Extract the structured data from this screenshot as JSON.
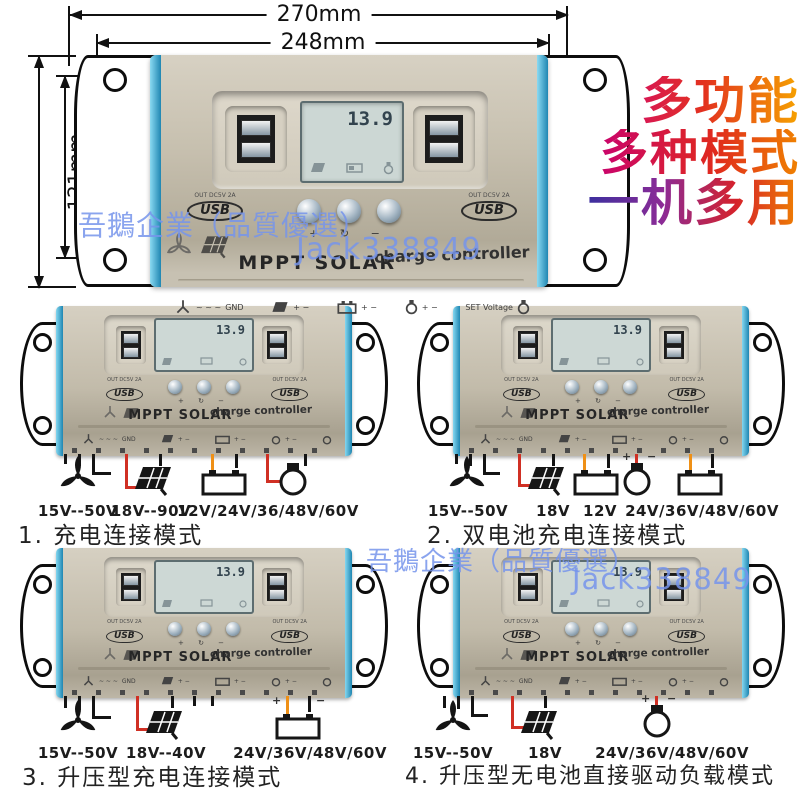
{
  "dimensions": {
    "top_outer": "270mm",
    "top_inner": "248mm",
    "side_outer": "121mm",
    "side_inner": "95mm"
  },
  "promo": {
    "line1": "多功能",
    "line2": "多种模式",
    "line3": "一机多用",
    "colors": {
      "magenta": "#cf0080",
      "red": "#e02a1d",
      "orange": "#f6a300",
      "purple": "#3c2f9f"
    }
  },
  "watermark": {
    "company": "吾鵝企業（品質優選）",
    "user": "Jack338849",
    "color": "#7694eb"
  },
  "controller": {
    "lcd_value": "13.9",
    "brand": "MPPT SOLAR",
    "product": "charge controller",
    "usb_output": "OUT DC5V 2A",
    "usb_logo": "USB",
    "gnd": "GND",
    "ac_marks": "~ ~ ~",
    "polarity": "+ −",
    "plus": "+",
    "minus": "−",
    "set_voltage": "SET Voltage",
    "button_glyphs": "+ ↻ −",
    "body_color": "#c6bfae",
    "accent_blue": "#2f96c0",
    "wire_colors": {
      "black": "#141414",
      "red": "#d03024",
      "orange": "#ef9016"
    }
  },
  "diagrams": [
    {
      "caption": "1. 充电连接模式",
      "labels": [
        {
          "text": "15V--50V"
        },
        {
          "text": "18V--90V"
        },
        {
          "text": "12V/24V/36/48V/60V"
        }
      ],
      "devices": [
        "wind-turbine",
        "solar-panel",
        "battery",
        "bulb"
      ]
    },
    {
      "caption": "2. 双电池充电连接模式",
      "labels": [
        {
          "text": "15V--50V"
        },
        {
          "text": "18V"
        },
        {
          "text": "12V"
        },
        {
          "text": "24V/36V/48V/60V"
        }
      ],
      "devices": [
        "wind-turbine",
        "solar-panel",
        "battery",
        "bulb",
        "battery"
      ]
    },
    {
      "caption": "3. 升压型充电连接模式",
      "labels": [
        {
          "text": "15V--50V"
        },
        {
          "text": "18V--40V"
        },
        {
          "text": "24V/36V/48V/60V"
        }
      ],
      "devices": [
        "wind-turbine",
        "solar-panel",
        "battery"
      ]
    },
    {
      "caption": "4. 升压型无电池直接驱动负载模式",
      "labels": [
        {
          "text": "15V--50V"
        },
        {
          "text": "18V"
        },
        {
          "text": "24V/36V/48V/60V"
        }
      ],
      "devices": [
        "wind-turbine",
        "solar-panel",
        "bulb"
      ]
    }
  ]
}
